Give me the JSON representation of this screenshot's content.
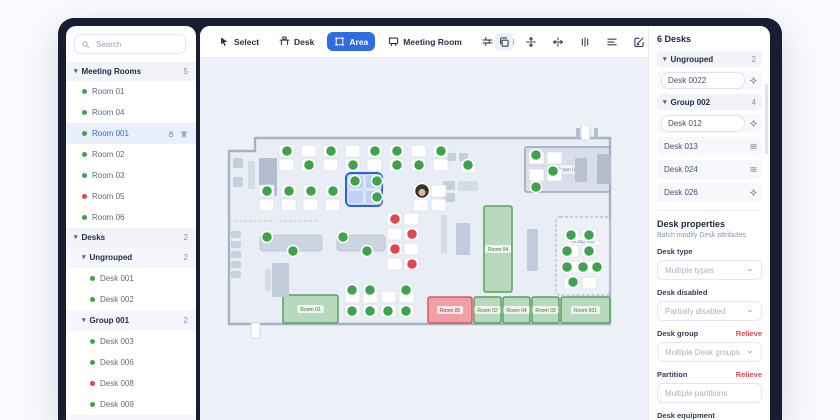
{
  "colors": {
    "accent": "#2f6ce0",
    "green": "#3fa34d",
    "red": "#e0474c",
    "frame": "#181d31",
    "canvas": "#eef1f8",
    "floor": "#e9edf6",
    "wall": "#a7b1c4",
    "selection": "#2b63d9"
  },
  "sidebar": {
    "search": {
      "placeholder": "Search"
    },
    "rows": [
      {
        "kind": "header",
        "label": "Meeting Rooms",
        "count": "5"
      },
      {
        "kind": "item",
        "label": "Room 01",
        "dot": "green"
      },
      {
        "kind": "item",
        "label": "Room 04",
        "dot": "green"
      },
      {
        "kind": "item",
        "label": "Room 001",
        "dot": "green",
        "selected": true,
        "icons": [
          "lock",
          "trash"
        ]
      },
      {
        "kind": "item",
        "label": "Room 02",
        "dot": "green"
      },
      {
        "kind": "item",
        "label": "Room 03",
        "dot": "green"
      },
      {
        "kind": "item",
        "label": "Room 05",
        "dot": "red"
      },
      {
        "kind": "item",
        "label": "Room 06",
        "dot": "green"
      },
      {
        "kind": "header",
        "label": "Desks",
        "count": "2"
      },
      {
        "kind": "subheader",
        "label": "Ungrouped",
        "count": "2"
      },
      {
        "kind": "item2",
        "label": "Desk 001",
        "dot": "green"
      },
      {
        "kind": "item2",
        "label": "Desk 002",
        "dot": "green"
      },
      {
        "kind": "subheader",
        "label": "Group 001",
        "count": "2"
      },
      {
        "kind": "item2",
        "label": "Desk 003",
        "dot": "green"
      },
      {
        "kind": "item2",
        "label": "Desk 006",
        "dot": "green"
      },
      {
        "kind": "item2",
        "label": "Desk 008",
        "dot": "red"
      },
      {
        "kind": "item2",
        "label": "Desk 009",
        "dot": "green"
      },
      {
        "kind": "subheader",
        "label": "Group 002",
        "count": "2"
      }
    ]
  },
  "toolbar": {
    "tools": [
      {
        "label": "Select",
        "icon": "cursor",
        "active": false
      },
      {
        "label": "Desk",
        "icon": "desk",
        "active": false
      },
      {
        "label": "Area",
        "icon": "area",
        "active": true
      },
      {
        "label": "Meeting Room",
        "icon": "meeting-room",
        "active": false
      },
      {
        "label": "Wall",
        "icon": "wall",
        "active": false
      }
    ],
    "actions": [
      {
        "icon": "duplicate",
        "highlight": true
      },
      {
        "icon": "align-vertical",
        "highlight": false
      },
      {
        "icon": "align-horizontal",
        "highlight": false
      },
      {
        "icon": "distribute",
        "highlight": false
      },
      {
        "icon": "align-lines",
        "highlight": false
      },
      {
        "icon": "edit",
        "highlight": false
      },
      {
        "icon": "trash",
        "highlight": false
      }
    ]
  },
  "panel": {
    "title": "6 Desks",
    "rows": [
      {
        "kind": "group",
        "label": "Ungrouped",
        "count": "2"
      },
      {
        "kind": "input",
        "label": "Desk 0022",
        "icon": "crosshair"
      },
      {
        "kind": "group",
        "label": "Group 002",
        "count": "4"
      },
      {
        "kind": "input",
        "label": "Desk 012",
        "icon": "crosshair"
      },
      {
        "kind": "plain",
        "label": "Desk 013",
        "icon": "menu"
      },
      {
        "kind": "plain",
        "label": "Desk 024",
        "icon": "menu"
      },
      {
        "kind": "plain",
        "label": "Desk 026",
        "icon": "crosshair"
      }
    ],
    "properties": {
      "title": "Desk properties",
      "subtitle": "Batch modify Desk attributes",
      "fields": [
        {
          "label": "Desk type",
          "placeholder": "Multiple types",
          "chevron": true,
          "action": ""
        },
        {
          "label": "Desk disabled",
          "placeholder": "Partially disabled",
          "chevron": true,
          "action": ""
        },
        {
          "label": "Desk group",
          "placeholder": "Multiple Desk groups",
          "chevron": true,
          "action": "Relieve"
        },
        {
          "label": "Partition",
          "placeholder": "Multiple partitions",
          "chevron": false,
          "action": "Relieve"
        },
        {
          "label": "Desk equipment",
          "placeholder": "",
          "chevron": false,
          "action": "",
          "labelOnly": true
        }
      ]
    }
  },
  "floorplan": {
    "outline": "M40,13 L395,13 L395,199 L14,199 L14,26 L40,26 Z",
    "dashedLines": [
      "M14 96 H58",
      "M64 96 H104"
    ],
    "rooms": [
      {
        "x": 310,
        "y": 22,
        "w": 85,
        "h": 45,
        "label": "Room 06",
        "type": "gray"
      },
      {
        "x": 269,
        "y": 81,
        "w": 28,
        "h": 86,
        "label": "Room 04",
        "type": "green"
      },
      {
        "x": 68,
        "y": 170,
        "w": 55,
        "h": 28,
        "label": "Room 01",
        "type": "green"
      },
      {
        "x": 213,
        "y": 172,
        "w": 44,
        "h": 26,
        "label": "Room 05",
        "type": "red"
      },
      {
        "x": 259,
        "y": 172,
        "w": 27,
        "h": 26,
        "label": "Room 02",
        "type": "green"
      },
      {
        "x": 288,
        "y": 172,
        "w": 27,
        "h": 26,
        "label": "Room 04",
        "type": "green"
      },
      {
        "x": 317,
        "y": 172,
        "w": 27,
        "h": 26,
        "label": "Room 03",
        "type": "green"
      },
      {
        "x": 346,
        "y": 172,
        "w": 49,
        "h": 26,
        "label": "Room 001",
        "type": "green"
      },
      {
        "x": 341,
        "y": 92,
        "w": 54,
        "h": 78,
        "label": "Group 002",
        "type": "dashed"
      }
    ],
    "furniture": [
      {
        "x": 18,
        "y": 33,
        "w": 10,
        "h": 10,
        "c": "#c6cedd"
      },
      {
        "x": 18,
        "y": 52,
        "w": 10,
        "h": 10,
        "c": "#c6cedd"
      },
      {
        "x": 33,
        "y": 36,
        "w": 7,
        "h": 28,
        "c": "#d4dae6"
      },
      {
        "x": 44,
        "y": 33,
        "w": 18,
        "h": 38,
        "c": "#b3bdce"
      },
      {
        "x": 228,
        "y": 56,
        "w": 12,
        "h": 9,
        "c": "#c6cedd"
      },
      {
        "x": 228,
        "y": 68,
        "w": 12,
        "h": 9,
        "c": "#c6cedd"
      },
      {
        "x": 243,
        "y": 56,
        "w": 20,
        "h": 10,
        "c": "#d4dae6"
      },
      {
        "x": 232,
        "y": 28,
        "w": 9,
        "h": 8,
        "c": "#c6cedd"
      },
      {
        "x": 244,
        "y": 28,
        "w": 9,
        "h": 8,
        "c": "#c6cedd"
      },
      {
        "x": 360,
        "y": 33,
        "w": 12,
        "h": 24,
        "c": "#b9c2d2"
      },
      {
        "x": 382,
        "y": 29,
        "w": 14,
        "h": 30,
        "c": "#b3bdce"
      },
      {
        "x": 16,
        "y": 106,
        "w": 10,
        "h": 7,
        "c": "#c9d1df"
      },
      {
        "x": 16,
        "y": 116,
        "w": 10,
        "h": 7,
        "c": "#c9d1df"
      },
      {
        "x": 16,
        "y": 126,
        "w": 10,
        "h": 7,
        "c": "#c9d1df"
      },
      {
        "x": 16,
        "y": 136,
        "w": 10,
        "h": 7,
        "c": "#c9d1df"
      },
      {
        "x": 16,
        "y": 146,
        "w": 10,
        "h": 7,
        "c": "#c9d1df"
      },
      {
        "x": 57,
        "y": 138,
        "w": 17,
        "h": 34,
        "c": "#c2cbd9"
      },
      {
        "x": 50,
        "y": 144,
        "w": 6,
        "h": 22,
        "c": "#d4dae6"
      },
      {
        "x": 241,
        "y": 98,
        "w": 14,
        "h": 32,
        "c": "#c2cbd9"
      },
      {
        "x": 226,
        "y": 90,
        "w": 6,
        "h": 38,
        "c": "#d4dae6"
      },
      {
        "x": 312,
        "y": 104,
        "w": 11,
        "h": 42,
        "c": "#c2cbd9"
      }
    ],
    "tables": [
      {
        "x": 45,
        "y": 110,
        "w": 62,
        "h": 16
      },
      {
        "x": 122,
        "y": 110,
        "w": 48,
        "h": 16
      }
    ],
    "desks": [
      {
        "x": 64,
        "y": 20
      },
      {
        "x": 86,
        "y": 20
      },
      {
        "x": 108,
        "y": 20
      },
      {
        "x": 130,
        "y": 20
      },
      {
        "x": 152,
        "y": 20
      },
      {
        "x": 174,
        "y": 20
      },
      {
        "x": 196,
        "y": 20
      },
      {
        "x": 218,
        "y": 20
      },
      {
        "x": 64,
        "y": 34
      },
      {
        "x": 86,
        "y": 34
      },
      {
        "x": 108,
        "y": 34
      },
      {
        "x": 130,
        "y": 34
      },
      {
        "x": 152,
        "y": 34
      },
      {
        "x": 174,
        "y": 34
      },
      {
        "x": 196,
        "y": 34
      },
      {
        "x": 218,
        "y": 34
      },
      {
        "x": 44,
        "y": 60
      },
      {
        "x": 66,
        "y": 60
      },
      {
        "x": 88,
        "y": 60
      },
      {
        "x": 110,
        "y": 60
      },
      {
        "x": 198,
        "y": 60
      },
      {
        "x": 216,
        "y": 60
      },
      {
        "x": 44,
        "y": 74
      },
      {
        "x": 66,
        "y": 74
      },
      {
        "x": 88,
        "y": 74
      },
      {
        "x": 110,
        "y": 74
      },
      {
        "x": 198,
        "y": 74
      },
      {
        "x": 216,
        "y": 74
      },
      {
        "x": 172,
        "y": 88
      },
      {
        "x": 189,
        "y": 88
      },
      {
        "x": 172,
        "y": 103
      },
      {
        "x": 189,
        "y": 103
      },
      {
        "x": 172,
        "y": 118
      },
      {
        "x": 189,
        "y": 118
      },
      {
        "x": 172,
        "y": 133
      },
      {
        "x": 189,
        "y": 133
      },
      {
        "x": 130,
        "y": 166
      },
      {
        "x": 148,
        "y": 166
      },
      {
        "x": 166,
        "y": 166
      },
      {
        "x": 184,
        "y": 166
      },
      {
        "x": 130,
        "y": 180
      },
      {
        "x": 148,
        "y": 180
      },
      {
        "x": 166,
        "y": 180
      },
      {
        "x": 184,
        "y": 180
      },
      {
        "x": 314,
        "y": 27
      },
      {
        "x": 332,
        "y": 27
      },
      {
        "x": 314,
        "y": 44
      },
      {
        "x": 332,
        "y": 44
      },
      {
        "x": 246,
        "y": 36
      },
      {
        "x": 349,
        "y": 104
      },
      {
        "x": 367,
        "y": 104
      },
      {
        "x": 349,
        "y": 120
      },
      {
        "x": 367,
        "y": 120
      },
      {
        "x": 349,
        "y": 136
      },
      {
        "x": 367,
        "y": 136
      },
      {
        "x": 349,
        "y": 152
      },
      {
        "x": 367,
        "y": 152
      }
    ],
    "dots": [
      {
        "x": 72,
        "y": 26,
        "c": "green"
      },
      {
        "x": 94,
        "y": 40,
        "c": "green"
      },
      {
        "x": 116,
        "y": 26,
        "c": "green"
      },
      {
        "x": 138,
        "y": 40,
        "c": "green"
      },
      {
        "x": 160,
        "y": 26,
        "c": "green"
      },
      {
        "x": 182,
        "y": 26,
        "c": "green"
      },
      {
        "x": 204,
        "y": 40,
        "c": "green"
      },
      {
        "x": 226,
        "y": 26,
        "c": "green"
      },
      {
        "x": 182,
        "y": 40,
        "c": "green"
      },
      {
        "x": 52,
        "y": 66,
        "c": "green"
      },
      {
        "x": 74,
        "y": 66,
        "c": "green"
      },
      {
        "x": 96,
        "y": 66,
        "c": "green"
      },
      {
        "x": 118,
        "y": 66,
        "c": "green"
      },
      {
        "x": 52,
        "y": 112,
        "c": "green"
      },
      {
        "x": 78,
        "y": 126,
        "c": "green"
      },
      {
        "x": 128,
        "y": 112,
        "c": "green"
      },
      {
        "x": 152,
        "y": 126,
        "c": "green"
      },
      {
        "x": 137,
        "y": 165,
        "c": "green"
      },
      {
        "x": 155,
        "y": 165,
        "c": "green"
      },
      {
        "x": 191,
        "y": 165,
        "c": "green"
      },
      {
        "x": 137,
        "y": 186,
        "c": "green"
      },
      {
        "x": 155,
        "y": 186,
        "c": "green"
      },
      {
        "x": 173,
        "y": 186,
        "c": "green"
      },
      {
        "x": 191,
        "y": 186,
        "c": "green"
      },
      {
        "x": 321,
        "y": 30,
        "c": "green"
      },
      {
        "x": 338,
        "y": 46,
        "c": "green"
      },
      {
        "x": 321,
        "y": 62,
        "c": "green"
      },
      {
        "x": 253,
        "y": 40,
        "c": "green"
      },
      {
        "x": 356,
        "y": 110,
        "c": "green"
      },
      {
        "x": 374,
        "y": 110,
        "c": "green"
      },
      {
        "x": 352,
        "y": 126,
        "c": "green"
      },
      {
        "x": 374,
        "y": 126,
        "c": "green"
      },
      {
        "x": 352,
        "y": 142,
        "c": "green"
      },
      {
        "x": 368,
        "y": 142,
        "c": "green"
      },
      {
        "x": 382,
        "y": 142,
        "c": "green"
      },
      {
        "x": 358,
        "y": 157,
        "c": "green"
      },
      {
        "x": 180,
        "y": 94,
        "c": "red"
      },
      {
        "x": 197,
        "y": 109,
        "c": "red"
      },
      {
        "x": 180,
        "y": 124,
        "c": "red"
      },
      {
        "x": 197,
        "y": 139,
        "c": "red"
      }
    ],
    "selection": {
      "x": 131,
      "y": 48,
      "w": 36,
      "h": 33,
      "tiles": [
        {
          "x": 133,
          "y": 50
        },
        {
          "x": 150,
          "y": 50
        },
        {
          "x": 133,
          "y": 65
        },
        {
          "x": 150,
          "y": 65
        }
      ],
      "dots": [
        {
          "x": 140,
          "y": 56
        },
        {
          "x": 162,
          "y": 56
        },
        {
          "x": 162,
          "y": 72
        }
      ]
    },
    "avatar": {
      "x": 207,
      "y": 66
    },
    "doorTags": [
      {
        "x": 366,
        "y": 0,
        "w": 9,
        "h": 15
      },
      {
        "x": 36,
        "y": 198,
        "w": 9,
        "h": 15
      }
    ],
    "stubs": [
      {
        "x": 361,
        "y": 3,
        "w": 4,
        "h": 10
      },
      {
        "x": 379,
        "y": 3,
        "w": 4,
        "h": 10
      }
    ]
  }
}
